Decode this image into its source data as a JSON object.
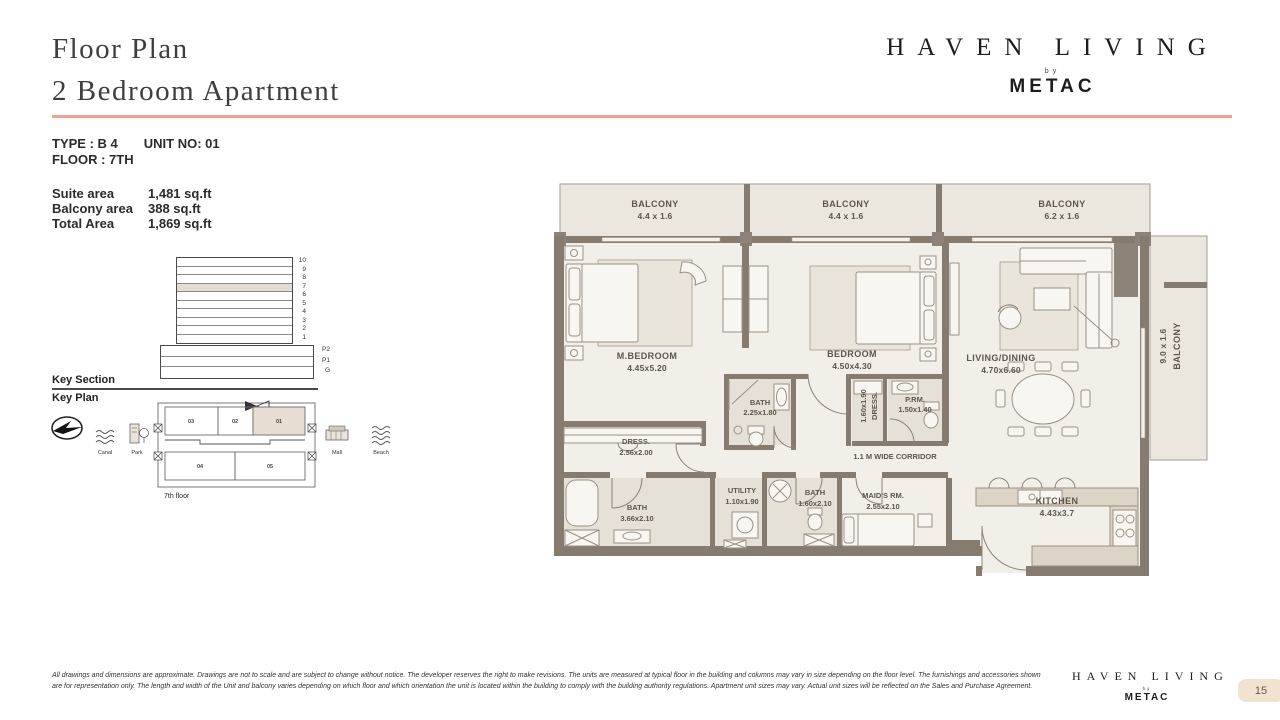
{
  "header": {
    "title_line1": "Floor Plan",
    "title_line2": "2 Bedroom Apartment"
  },
  "brand": {
    "name": "HAVEN LIVING",
    "by": "by",
    "company": "METAC"
  },
  "unit_info": {
    "type": "TYPE : B 4",
    "unit_no": "UNIT NO: 01",
    "floor": "FLOOR : 7TH"
  },
  "areas": {
    "rows": [
      {
        "label": "Suite area",
        "value": "1,481 sq.ft"
      },
      {
        "label": "Balcony area",
        "value": "388 sq.ft"
      },
      {
        "label": "Total Area",
        "value": "1,869 sq.ft"
      }
    ]
  },
  "key_section": {
    "title": "Key Section",
    "floors": [
      "10",
      "9",
      "8",
      "7",
      "6",
      "5",
      "4",
      "3",
      "2",
      "1"
    ],
    "levels": [
      "P2",
      "P1",
      "G"
    ],
    "highlighted_floor": "7"
  },
  "key_plan": {
    "title": "Key Plan",
    "landmarks": {
      "canal": "Canal",
      "park": "Park",
      "mall": "Mall",
      "beach": "Beach"
    },
    "units": {
      "u01": "01",
      "u02": "02",
      "u03": "03",
      "u04": "04",
      "u05": "05"
    },
    "highlighted_unit": "01",
    "floor_label": "7th floor"
  },
  "floor_plan": {
    "rooms": {
      "balcony_1": {
        "name": "BALCONY",
        "dims": "4.4 x 1.6"
      },
      "balcony_2": {
        "name": "BALCONY",
        "dims": "4.4 x 1.6"
      },
      "balcony_3": {
        "name": "BALCONY",
        "dims": "6.2 x 1.6"
      },
      "balcony_right": {
        "name": "BALCONY",
        "dims": "9.0 x 1.6"
      },
      "m_bedroom": {
        "name": "M.BEDROOM",
        "dims": "4.45x5.20"
      },
      "bedroom": {
        "name": "BEDROOM",
        "dims": "4.50x4.30"
      },
      "living_dining": {
        "name": "LIVING/DINING",
        "dims": "4.70x6.60"
      },
      "bath_ensuite": {
        "name": "BATH",
        "dims": "2.25x1.80"
      },
      "dress_2": {
        "name": "DRESS.",
        "dims": "1.60x1.90"
      },
      "powder_room": {
        "name": "P.RM.",
        "dims": "1.50x1.40"
      },
      "dress_1": {
        "name": "DRESS.",
        "dims": "2.56x2.00"
      },
      "corridor": {
        "name": "1.1 M WIDE CORRIDOR"
      },
      "bath_main": {
        "name": "BATH",
        "dims": "3.66x2.10"
      },
      "utility": {
        "name": "UTILITY",
        "dims": "1.10x1.90"
      },
      "bath_2": {
        "name": "BATH",
        "dims": "1.60x2.10"
      },
      "maids_room": {
        "name": "MAID'S RM.",
        "dims": "2.55x2.10"
      },
      "kitchen": {
        "name": "KITCHEN",
        "dims": "4.43x3.7"
      }
    }
  },
  "footer": {
    "disclaimer": "All drawings and dimensions are approximate. Drawings are not to scale and are subject to change without notice. The developer reserves the right to make revisions. The units are measured at typical floor in the building and columns may vary in size depending on the floor level. The furnishings and accessories shown are for representation only. The length and width of the Unit and balcony varies depending on which floor and which orientation the unit is located within the building to comply with the building authority regulations. Apartment unit sizes may vary. Actual unit sizes will be reflected on the Sales and Purchase Agreement.",
    "page_number": "15"
  },
  "colors": {
    "accent": "#f2a18c",
    "wall": "#867b6f",
    "room_fill": "#f2efe9",
    "balcony_fill": "#ebe7df",
    "highlight_fill": "#e3ded3",
    "badge_bg": "#f1e3cf"
  }
}
